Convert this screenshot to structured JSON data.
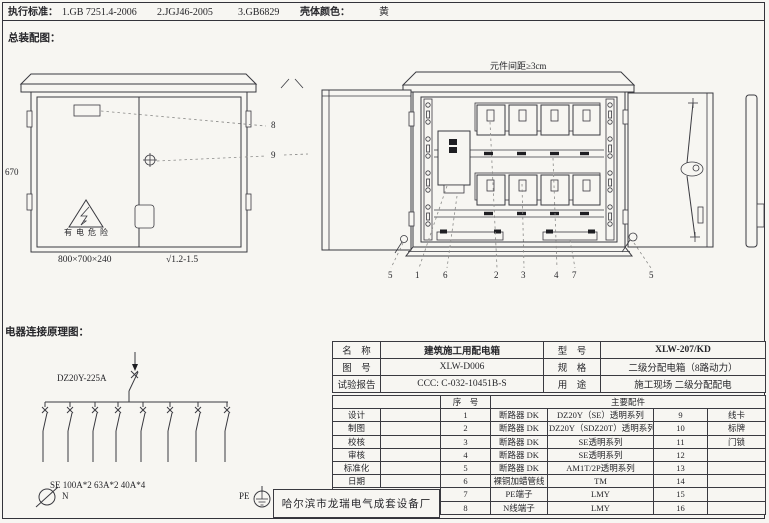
{
  "header": {
    "standards_label": "执行标准：",
    "standards": [
      "1.GB 7251.4-2006",
      "2.JGJ46-2005",
      "3.GB6829"
    ],
    "shell_color_label": "壳体颜色：",
    "shell_color_value": "黄"
  },
  "assembly": {
    "title": "总装配图：",
    "dim_height": "670",
    "dim_size": "800×700×240",
    "surface_mark": "√1.2-1.5",
    "warning": "有电危险",
    "callout_8": "8",
    "callout_9": "9"
  },
  "open_view": {
    "spacing_note": "元件间距≥3cm",
    "callouts": [
      "5",
      "1",
      "6",
      "2",
      "3",
      "4",
      "7",
      "5"
    ]
  },
  "schematic": {
    "title": "电器连接原理图：",
    "main_breaker": "DZ20Y-225A",
    "branch_spec": "SE 100A*2 63A*2 40A*4",
    "neutral_label": "N",
    "pe_label": "PE"
  },
  "table": {
    "info_rows": [
      {
        "k1": "名　称",
        "v1": "建筑施工用配电箱",
        "k2": "型　号",
        "v2": "XLW-207/KD"
      },
      {
        "k1": "图　号",
        "v1": "XLW-D006",
        "k2": "规　格",
        "v2": "二级分配电箱（8路动力）"
      },
      {
        "k1": "试验报告",
        "v1": "CCC: C-032-10451B-S",
        "k2": "用　途",
        "v2": "施工现场 二级分配配电"
      }
    ],
    "serial_header": "序　号",
    "parts_header": "主要配件",
    "sign_labels": [
      "设计",
      "制图",
      "校核",
      "审核",
      "标准化",
      "日期"
    ],
    "rows": [
      {
        "no": "1",
        "part": "断路器 DK",
        "spec": "DZ20Y（SE）透明系列",
        "no2": "9",
        "part2": "线卡"
      },
      {
        "no": "2",
        "part": "断路器 DK",
        "spec": "DZ20Y（SDZ20T）透明系列",
        "no2": "10",
        "part2": "标牌"
      },
      {
        "no": "3",
        "part": "断路器 DK",
        "spec": "SE透明系列",
        "no2": "11",
        "part2": "门锁"
      },
      {
        "no": "4",
        "part": "断路器 DK",
        "spec": "SE透明系列",
        "no2": "12",
        "part2": ""
      },
      {
        "no": "5",
        "part": "断路器 DK",
        "spec": "AM1T/2P透明系列",
        "no2": "13",
        "part2": ""
      },
      {
        "no": "6",
        "part": "裸铜加蜡管线",
        "spec": "TM",
        "no2": "14",
        "part2": ""
      },
      {
        "no": "7",
        "part": "PE端子",
        "spec": "LMY",
        "no2": "15",
        "part2": ""
      },
      {
        "no": "8",
        "part": "N线端子",
        "spec": "LMY",
        "no2": "16",
        "part2": ""
      }
    ],
    "company": "哈尔滨市龙瑞电气成套设备厂"
  }
}
